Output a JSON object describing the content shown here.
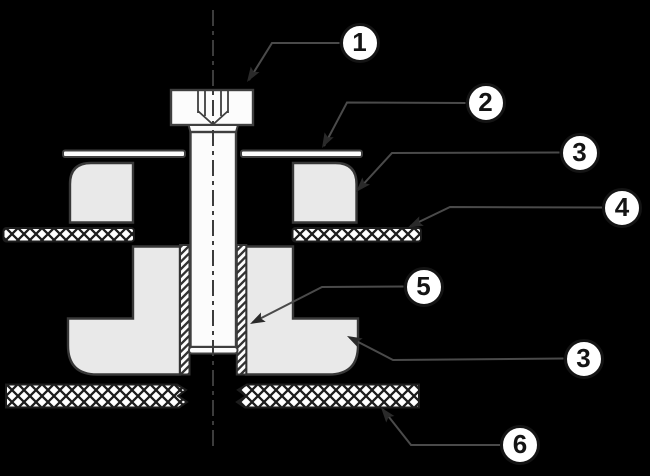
{
  "figure": {
    "type": "technical-cross-section-diagram",
    "callouts": [
      {
        "id": "callout-1",
        "label": "1"
      },
      {
        "id": "callout-2",
        "label": "2"
      },
      {
        "id": "callout-3-upper",
        "label": "3"
      },
      {
        "id": "callout-4",
        "label": "4"
      },
      {
        "id": "callout-5",
        "label": "5"
      },
      {
        "id": "callout-3-lower",
        "label": "3"
      },
      {
        "id": "callout-6",
        "label": "6"
      }
    ],
    "colors": {
      "background": "#000000",
      "metal_fill": "#fcfcfc",
      "rubber_fill": "#e9e9e9",
      "outline": "#3f3f3f",
      "hatch_dark": "#1c1c1c",
      "leader_line": "#4a4a4a",
      "callout_text": "#141414"
    }
  }
}
